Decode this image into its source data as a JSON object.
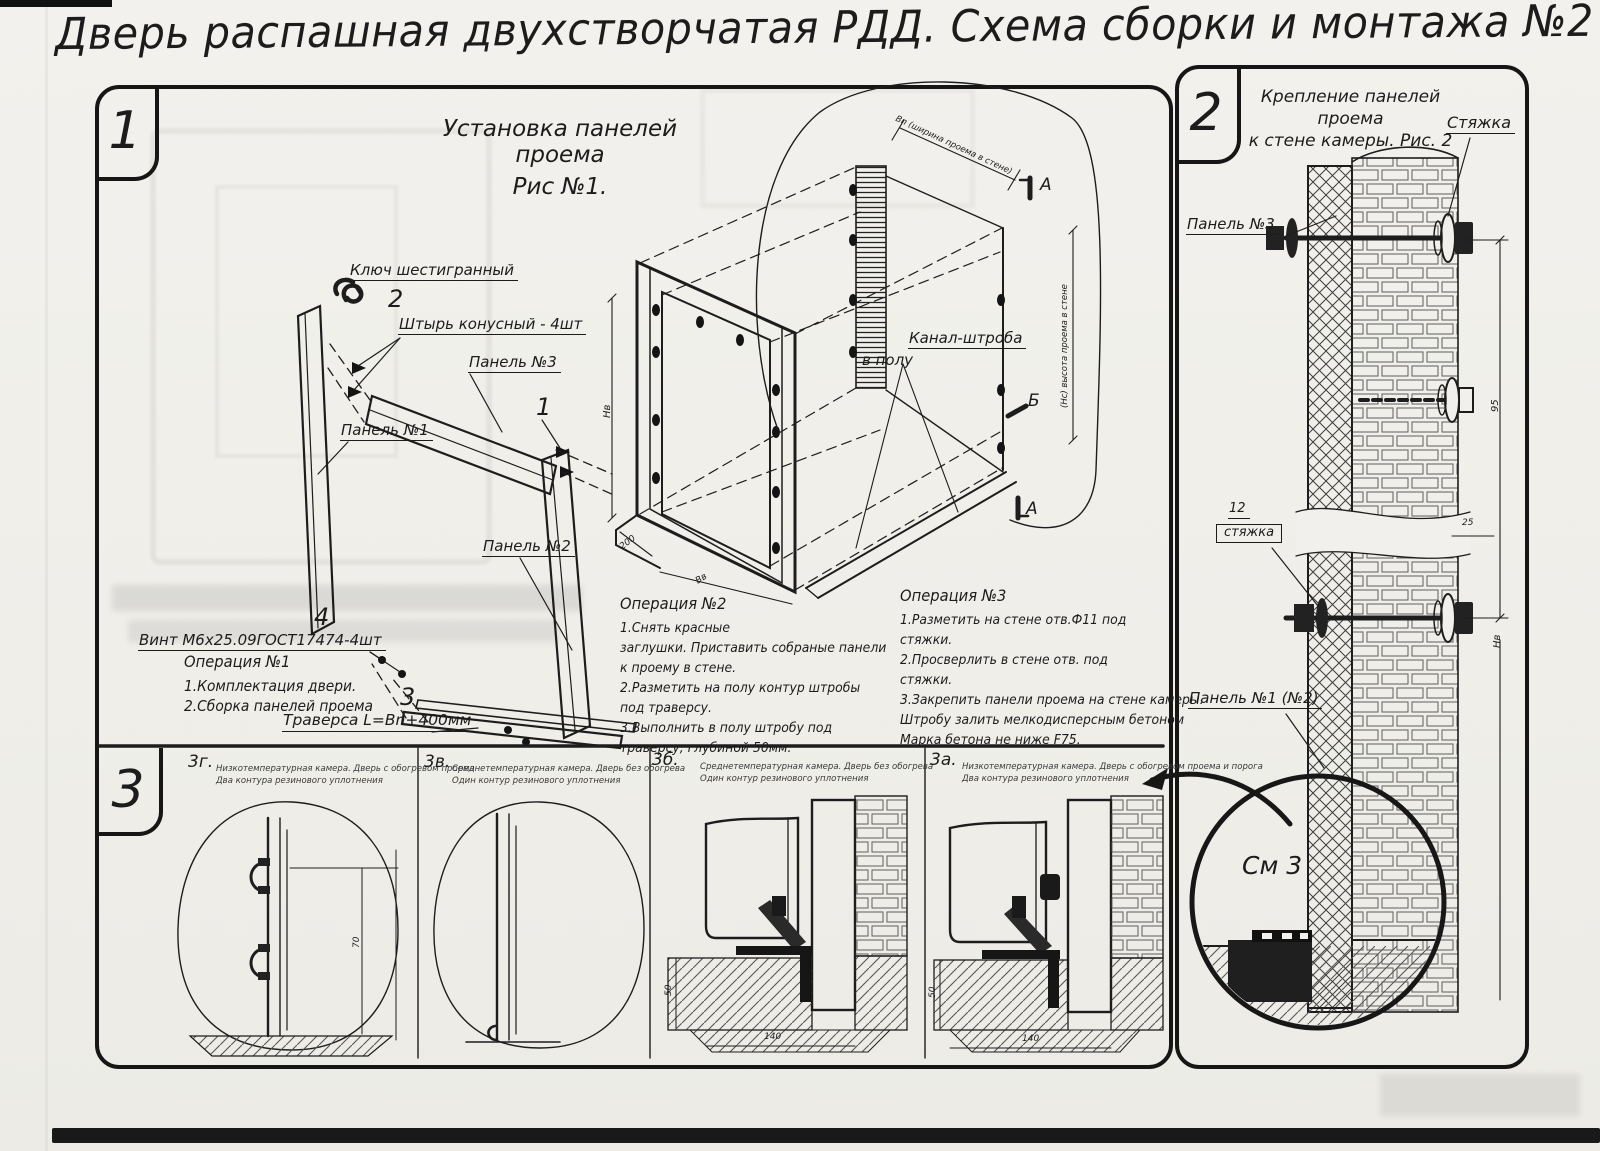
{
  "title": "Дверь распашная двухстворчатая РДД.  Схема сборки и монтажа №2",
  "fig1": {
    "badge": "1",
    "title1": "Установка панелей проема",
    "title2": "Рис №1.",
    "callouts": {
      "hex_key": "Ключ шестигранный",
      "num2": "2",
      "pin": "Штырь конусный - 4шт",
      "panel3": "Панель №3",
      "num1": "1",
      "panel1": "Панель №1",
      "panel2": "Панель №2",
      "num4": "4",
      "screw": "Винт М6х25.09ГОСТ17474-4шт",
      "num3": "3",
      "traverse": "Траверса  L=Bn+400мм",
      "channel1": "Канал-штроба",
      "channel2": "в полу",
      "marker_a": "А",
      "marker_b": "Б"
    },
    "dims": {
      "width_top": "Вп (ширина проема в стене)",
      "height_right": "(Нс) высота проема в стене",
      "hv": "Нв",
      "d200": "200",
      "bv": "Вв"
    },
    "op1_title": "Операция №1",
    "op1_lines": [
      "1.Комплектация двери.",
      "2.Сборка панелей проема"
    ],
    "op2_title": "Операция №2",
    "op2_lines": [
      "1.Снять красные",
      "заглушки. Приставить собраные панели",
      "к проему в стене.",
      "2.Разметить на полу контур штробы",
      "под траверсу.",
      "3.Выполнить в полу штробу под",
      "траверсу, глубиной 50мм."
    ],
    "op3_title": "Операция №3",
    "op3_lines": [
      "1.Разметить на стене отв.Ф11 под",
      "стяжки.",
      "2.Просверлить в стене отв.   под",
      "стяжки.",
      "3.Закрепить панели проема на стене камеры.",
      "Штробу залить мелкодисперсным бетоном",
      "Марка бетона не ниже   F75."
    ]
  },
  "fig2": {
    "badge": "2",
    "title1": "Крепление панелей проема",
    "title2": "к стене камеры. Рис. 2",
    "callouts": {
      "tie_top": "Стяжка",
      "panel3": "Панель №3",
      "num12": "12",
      "tie_boxed": "стяжка",
      "panel12": "Панель №1 (№2)",
      "see3": "См 3"
    },
    "dims": {
      "d95": "95",
      "d25": "25",
      "hv": "Нв"
    }
  },
  "fig3": {
    "badge": "3",
    "panels": [
      {
        "id": "3г.",
        "line1": "Низкотемпературная камера. Дверь с обогревом проема",
        "line2": "Два контура резинового уплотнения"
      },
      {
        "id": "3в.",
        "line1": "Среднетемпературная камера. Дверь без обогрева",
        "line2": "Один контур резинового уплотнения"
      },
      {
        "id": "3б.",
        "line1": "Среднетемпературная камера. Дверь без обогрева",
        "line2": "Один контур резинового уплотнения"
      },
      {
        "id": "3а.",
        "line1": "Низкотемпературная камера. Дверь с обогревом проема и порога",
        "line2": "Два контура резинового уплотнения"
      }
    ],
    "dims": {
      "d70": "70",
      "d50": "50",
      "d140": "140"
    }
  }
}
